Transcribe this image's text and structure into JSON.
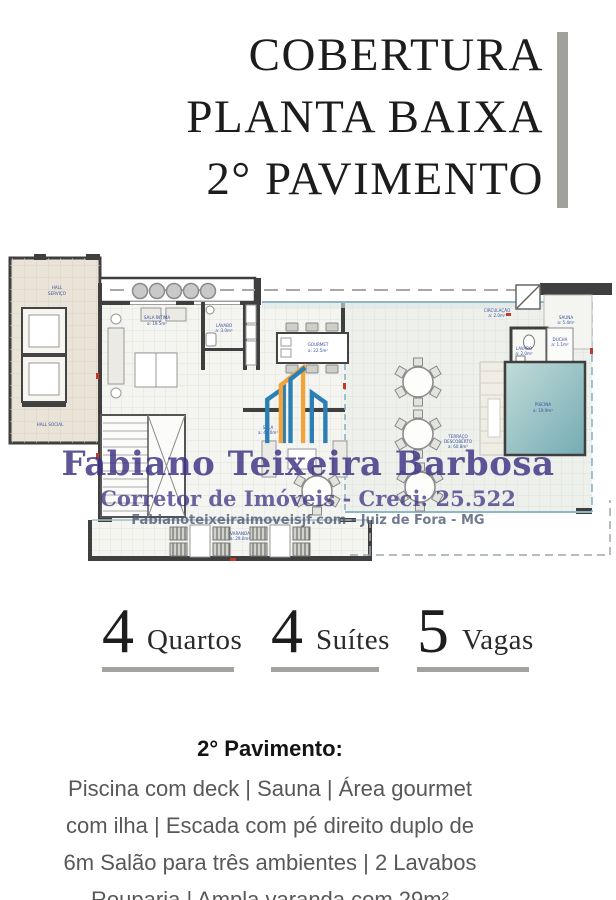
{
  "title": {
    "lines": [
      "COBERTURA",
      "PLANTA BAIXA",
      "2° PAVIMENTO"
    ]
  },
  "floorplan": {
    "labels": {
      "hall_servico_1": "HALL",
      "hall_servico_2": "SERVIÇO",
      "hall_social": "HALL SOCIAL",
      "sala_intima": "SALA ÍNTIMA",
      "sala_intima_area": "a: 19.5m²",
      "lavabo1": "LAVABO",
      "lavabo1_area": "a: 3.0m²",
      "gourmet": "GOURMET",
      "gourmet_area": "a: 22.5m²",
      "sala": "SALA",
      "sala_area": "a: 45.0m²",
      "circulacao": "CIRCULAÇÃO",
      "circulacao_area": "a: 2.0m²",
      "sauna": "SAUNA",
      "sauna_area": "a: 5.4m²",
      "lavabo2": "LAVABO",
      "lavabo2_area": "a: 2.0m²",
      "ducha": "DUCHA",
      "ducha_area": "a: 1.1m²",
      "piscina": "PISCINA",
      "piscina_area": "a: 19.9m²",
      "terraco_1": "TERRAÇO",
      "terraco_2": "DESCOBERTO",
      "terraco_area": "a: 60.8m²",
      "varanda": "VARANDA",
      "varanda_area": "a: 29.0m²"
    },
    "watermark": {
      "name": "Fabiano Teixeira Barbosa",
      "subtitle": "Corretor de Imóveis - Creci: 25.522",
      "website": "Fabianoteixeiraimoveisjf.com - Juiz de Fora - MG"
    },
    "colors": {
      "pool": "#8fbec4",
      "wall": "#3f3f3f",
      "watermark_purple": "#3e3387",
      "logo_orange": "#f2a33a",
      "logo_blue": "#2b7fb5",
      "accent_bar": "#a0a19b"
    }
  },
  "stats": [
    {
      "value": "4",
      "label": "Quartos"
    },
    {
      "value": "4",
      "label": "Suítes"
    },
    {
      "value": "5",
      "label": "Vagas"
    }
  ],
  "description": {
    "heading": "2° Pavimento:",
    "lines": [
      "Piscina com deck | Sauna | Área gourmet",
      "com ilha | Escada com pé direito duplo de",
      "6m Salão para três ambientes | 2 Lavabos",
      "Rouparia | Ampla varanda com 29m²"
    ]
  }
}
